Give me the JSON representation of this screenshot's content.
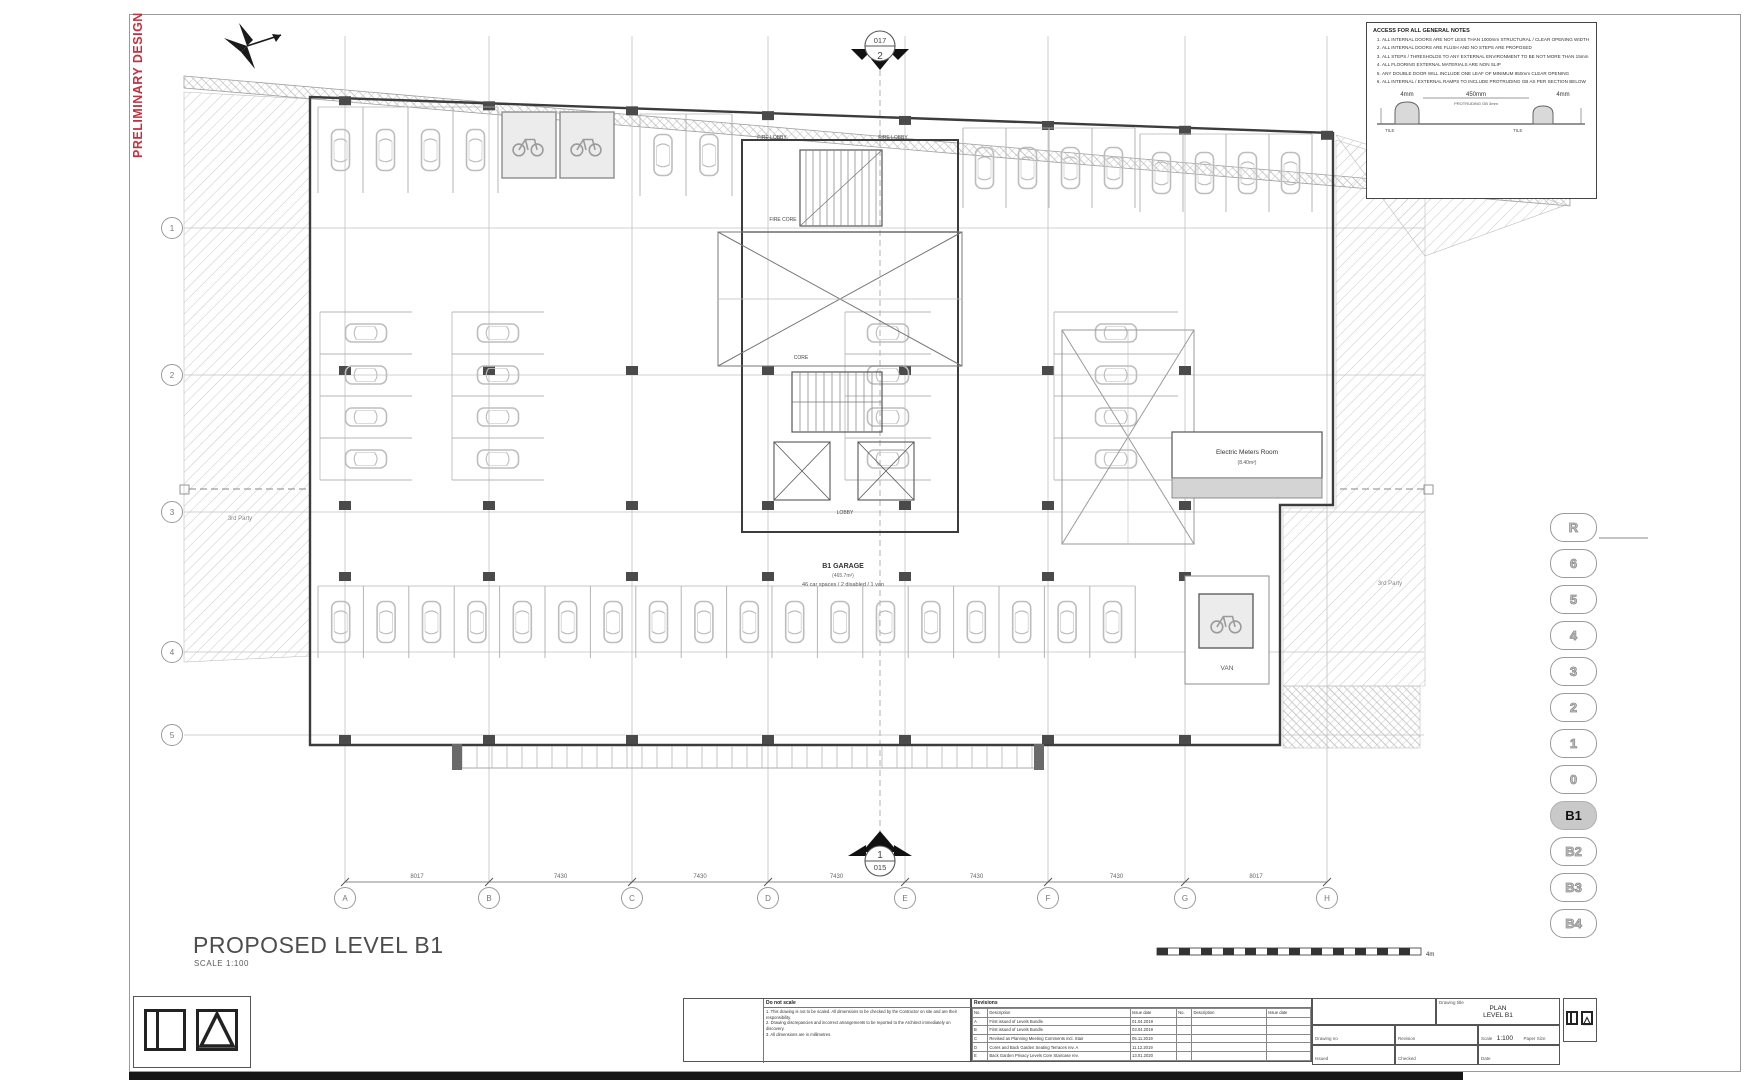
{
  "sheet": {
    "preliminary": "PRELIMINARY DESIGN",
    "title": "PROPOSED LEVEL B1",
    "scale_label": "SCALE 1:100"
  },
  "notes_box": {
    "title": "ACCESS FOR ALL GENERAL NOTES",
    "items": [
      "ALL INTERNAL DOORS ARE NOT LESS THAN 1000mm STRUCTURAL / CLEAR OPENING WIDTH",
      "ALL INTERNAL DOORS ARE FLUSH AND NO STEPS ARE PROPOSED",
      "ALL STEPS / THRESHOLDS TO ANY EXTERNAL ENVIRONMENT TO BE NOT MORE THAN 15mm",
      "ALL FLOORING EXTERNAL MATERIALS ARE NON SLIP",
      "ANY DOUBLE DOOR WILL INCLUDE ONE LEAF OF MINIMUM 850mm CLEAR OPENING",
      "ALL INTERNAL / EXTERNAL RAMPS TO INCLUDE PROTRUDING GB AS PER SECTION BELOW"
    ],
    "detail": {
      "dim_left": "4mm",
      "dim_mid": "450mm",
      "dim_right": "4mm",
      "tile_left": "TILE",
      "tile_right": "TILE",
      "protruding": "PROTRUDING GB 3mm"
    }
  },
  "section_markers": {
    "top": {
      "number": "2",
      "sheet": "017"
    },
    "bottom": {
      "number": "1",
      "sheet": "015"
    }
  },
  "grid": {
    "columns": [
      "A",
      "B",
      "C",
      "D",
      "E",
      "F",
      "G",
      "H"
    ],
    "rows": [
      "1",
      "2",
      "3",
      "4",
      "5"
    ],
    "dims": [
      "8017",
      "7430",
      "7430",
      "7430",
      "7430",
      "7430",
      "8017"
    ]
  },
  "plan": {
    "labels": {
      "fire_lobby_left": "FIRE LOBBY",
      "fire_lobby_right": "FIRE LOBBY",
      "fire_core": "FIRE CORE",
      "core": "CORE",
      "lobby": "LOBBY",
      "third_party_left": "3rd Party",
      "third_party_right": "3rd Party",
      "van": "VAN"
    },
    "garage": {
      "name": "B1 GARAGE",
      "area": "(465.7m²)",
      "spaces": "46 car spaces / 2 disabled / 1 van"
    },
    "emr": {
      "name": "Electric Meters Room",
      "area": "(8.40m²)"
    },
    "parking": [
      {
        "x": 318,
        "y": 107,
        "count": 4,
        "stall": 45,
        "depth": 86,
        "orient": "h"
      },
      {
        "x": 640,
        "y": 114,
        "count": 2,
        "stall": 46,
        "depth": 82,
        "orient": "h"
      },
      {
        "x": 963,
        "y": 128,
        "count": 4,
        "stall": 43,
        "depth": 80,
        "orient": "h"
      },
      {
        "x": 1140,
        "y": 134,
        "count": 4,
        "stall": 43,
        "depth": 78,
        "orient": "h"
      },
      {
        "x": 320,
        "y": 312,
        "count": 4,
        "stall": 42,
        "depth": 92,
        "orient": "v"
      },
      {
        "x": 452,
        "y": 312,
        "count": 4,
        "stall": 42,
        "depth": 92,
        "orient": "v"
      },
      {
        "x": 845,
        "y": 312,
        "count": 4,
        "stall": 42,
        "depth": 86,
        "orient": "v"
      },
      {
        "x": 1054,
        "y": 312,
        "count": 4,
        "stall": 42,
        "depth": 124,
        "orient": "v"
      },
      {
        "x": 318,
        "y": 586,
        "count": 18,
        "stall": 45.4,
        "depth": 72,
        "orient": "h"
      }
    ]
  },
  "levels": {
    "items": [
      "R",
      "6",
      "5",
      "4",
      "3",
      "2",
      "1",
      "0",
      "B1",
      "B2",
      "B3",
      "B4"
    ],
    "active": "B1"
  },
  "scale_bar": {
    "label": "4m"
  },
  "titleblock": {
    "notes_title": "Do not scale",
    "notes": [
      "1. This drawing is not to be scaled. All dimensions to be checked by the Contractor on site and are their responsibility.",
      "2. Drawing discrepancies and incorrect arrangements to be reported to the Architect immediately on discovery.",
      "3. All dimensions are in millimetres."
    ],
    "revisions_title": "Revisions",
    "rev_columns": [
      "No.",
      "Description",
      "Issue date",
      "No.",
      "Description",
      "Issue date"
    ],
    "rev_rows": [
      [
        "A",
        "First issued of Levels Bundle",
        "01.04.2019",
        "",
        "",
        ""
      ],
      [
        "B",
        "First issued of Levels Bundle",
        "03.04.2019",
        "",
        "",
        ""
      ],
      [
        "C",
        "Revised as Planning Meeting Comments incl. Stair",
        "05.11.2019",
        "",
        "",
        ""
      ],
      [
        "D",
        "Cores and Back Garden Seating Terraces rev. A",
        "11.12.2019",
        "",
        "",
        ""
      ],
      [
        "E",
        "Back Garden Privacy Levels Core Staircase rev.",
        "13.01.2020",
        "",
        "",
        ""
      ]
    ],
    "fields": {
      "drawing_title_label": "Drawing title",
      "drawing_title_1": "PLAN",
      "drawing_title_2": "LEVEL B1",
      "drawing_no_label": "Drawing no",
      "drawing_no": "F2015-A-100",
      "revision_label": "Revision",
      "revision": "E",
      "scale_label": "Scale",
      "scale": "1:100",
      "paper_label": "Paper Size",
      "paper": "A1",
      "drawn_label": "Issued",
      "drawn": "SC",
      "checked_label": "Checked",
      "checked": "RO",
      "date_label": "Date",
      "date": "26.05.2019"
    }
  }
}
